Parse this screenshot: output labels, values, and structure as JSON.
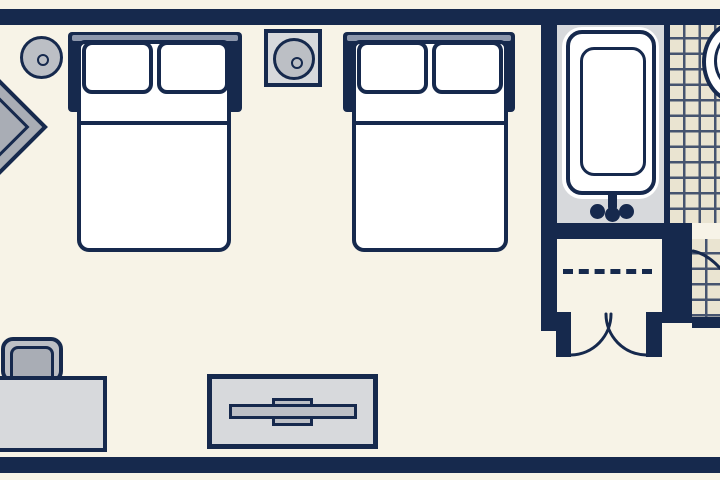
{
  "scene": "hotel guest room floor plan",
  "rooms": [
    "bedroom",
    "bathroom",
    "closet"
  ],
  "furniture_legend": [
    {
      "name": "ceiling-light-1",
      "type": "round ceiling light symbol"
    },
    {
      "name": "corner-table",
      "type": "diamond corner table, cut off at left edge"
    },
    {
      "name": "bed-1",
      "type": "double bed with headboard, two pillows, sheet fold line"
    },
    {
      "name": "nightstand",
      "type": "square nightstand with round table lamp"
    },
    {
      "name": "bed-2",
      "type": "double bed with headboard, two pillows, sheet fold line"
    },
    {
      "name": "bathtub",
      "type": "bathtub with inner basin, two faucet knobs and spout"
    },
    {
      "name": "toilet",
      "type": "toilet partially visible at top right on tiled floor"
    },
    {
      "name": "tiled-floor",
      "type": "bathroom tile grid"
    },
    {
      "name": "closet",
      "type": "closet with dashed hanging rod and double swing doors"
    },
    {
      "name": "bathroom-door",
      "type": "door swing arc at right edge"
    },
    {
      "name": "desk-chair",
      "type": "chair tucked at desk"
    },
    {
      "name": "desk",
      "type": "desk against bottom-left wall, cut off at left edge"
    },
    {
      "name": "tv-console",
      "type": "dresser console with flat TV on top"
    }
  ],
  "colors": {
    "wall": "#16294d",
    "floor": "#f7f3e7",
    "white": "#ffffff",
    "gray_light": "#d7d9dc",
    "gray_mid": "#bcbfc5",
    "gray_dark": "#a9adb5",
    "headboard_highlight": "#8d97ac",
    "tile": "#eae4d1",
    "tile_line": "#46546f"
  }
}
